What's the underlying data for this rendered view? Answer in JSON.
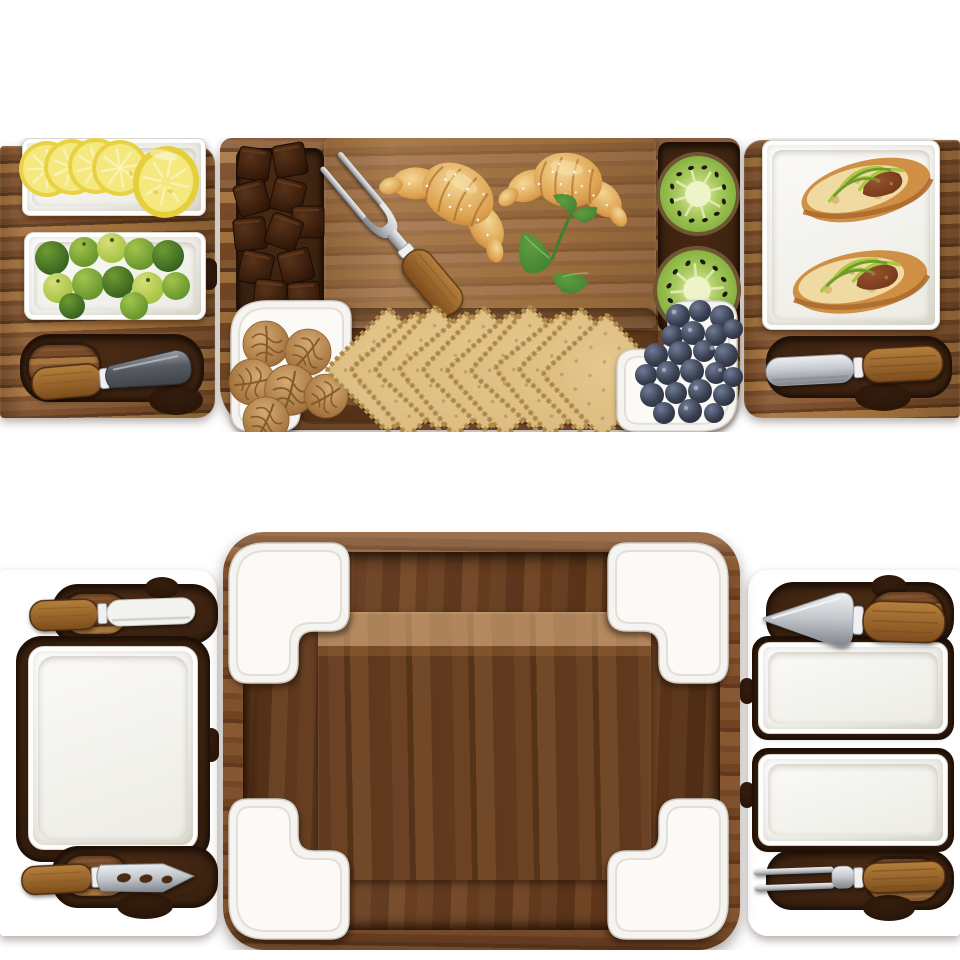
{
  "meta": {
    "type": "product photo collage",
    "subject": "Acacia wood charcuterie and cheese board set with pull-out drawers, white ceramic dishes and stainless cheese tools",
    "views": [
      "board styled with food (top)",
      "empty board set (bottom)"
    ]
  },
  "top_view": {
    "title": "Charcuterie board styled with food",
    "items": [
      "lemon slices and half lemon on white dish",
      "baby limes on white rectangular dish",
      "dark steel cheese knife in carved slot",
      "dark chocolate cubes in side channel",
      "two-prong cheese fork",
      "two croissants on raised cutting board",
      "fresh mint sprig",
      "two kiwi halves in side channel",
      "walnuts in L-shaped corner dish",
      "fanned square wheat crackers",
      "blueberries in L-shaped corner dish",
      "white serving plate with two baguette sandwiches",
      "stainless cheese spreader in carved slot"
    ]
  },
  "bottom_view": {
    "title": "Empty acacia board showing drawers, ceramic dishes and tools",
    "items": [
      "left pull-out drawer with square ceramic plate",
      "white-bladed cheese spreader",
      "pronged cheese knife with open-work blade",
      "four L-shaped ceramic corner dishes",
      "recessed center cutting area",
      "right pull-out drawer with two rectangular ceramic dishes",
      "spade-blade cheese knife",
      "two-prong cheese fork"
    ]
  },
  "palette": {
    "wood-light": "#a9763f",
    "wood-mid": "#8a5a33",
    "wood-base": "#7a4b27",
    "wood-dark": "#5f3a1e",
    "wood-deep": "#4a2a14",
    "recess": "#331d0d",
    "recess-dark": "#241106",
    "drawer-b-light": "#a87038",
    "drawer-b-mid": "#915d2e",
    "dish-white": "#f5f4f0",
    "dish-floor": "#fbfaf7",
    "dish-shade": "#dddacf",
    "steel-light": "#eef0f2",
    "steel": "#c2c6cb",
    "steel-dark": "#7e848b",
    "steel-deep": "#3f444a",
    "handle-light": "#b5803d",
    "handle-dark": "#7d4c1b",
    "lemon-rind": "#e8d243",
    "lemon-flesh": "#f4e87f",
    "lemon-pale": "#fbf4ba",
    "lime-dark": "#2f5c1d",
    "lime-mid": "#5d8f28",
    "lime-light": "#9ebf3a",
    "choc-dark": "#2b1406",
    "choc-light": "#59331a",
    "kiwi-skin": "#6f5533",
    "kiwi-flesh": "#7fae3a",
    "kiwi-core": "#eef3c8",
    "berry-dark": "#23283a",
    "berry-light": "#707b96",
    "walnut-light": "#d6ab72",
    "walnut-dark": "#8a5c2d",
    "cracker": "#dcbc80",
    "cracker-edge": "#b88f4f",
    "bread-light": "#f4d795",
    "bread-dark": "#b97b31",
    "crust": "#a96a2a",
    "greens": "#a9c83f",
    "greens-dark": "#6f9a2c",
    "meat": "#6f3519",
    "mint": "#3f8030"
  }
}
